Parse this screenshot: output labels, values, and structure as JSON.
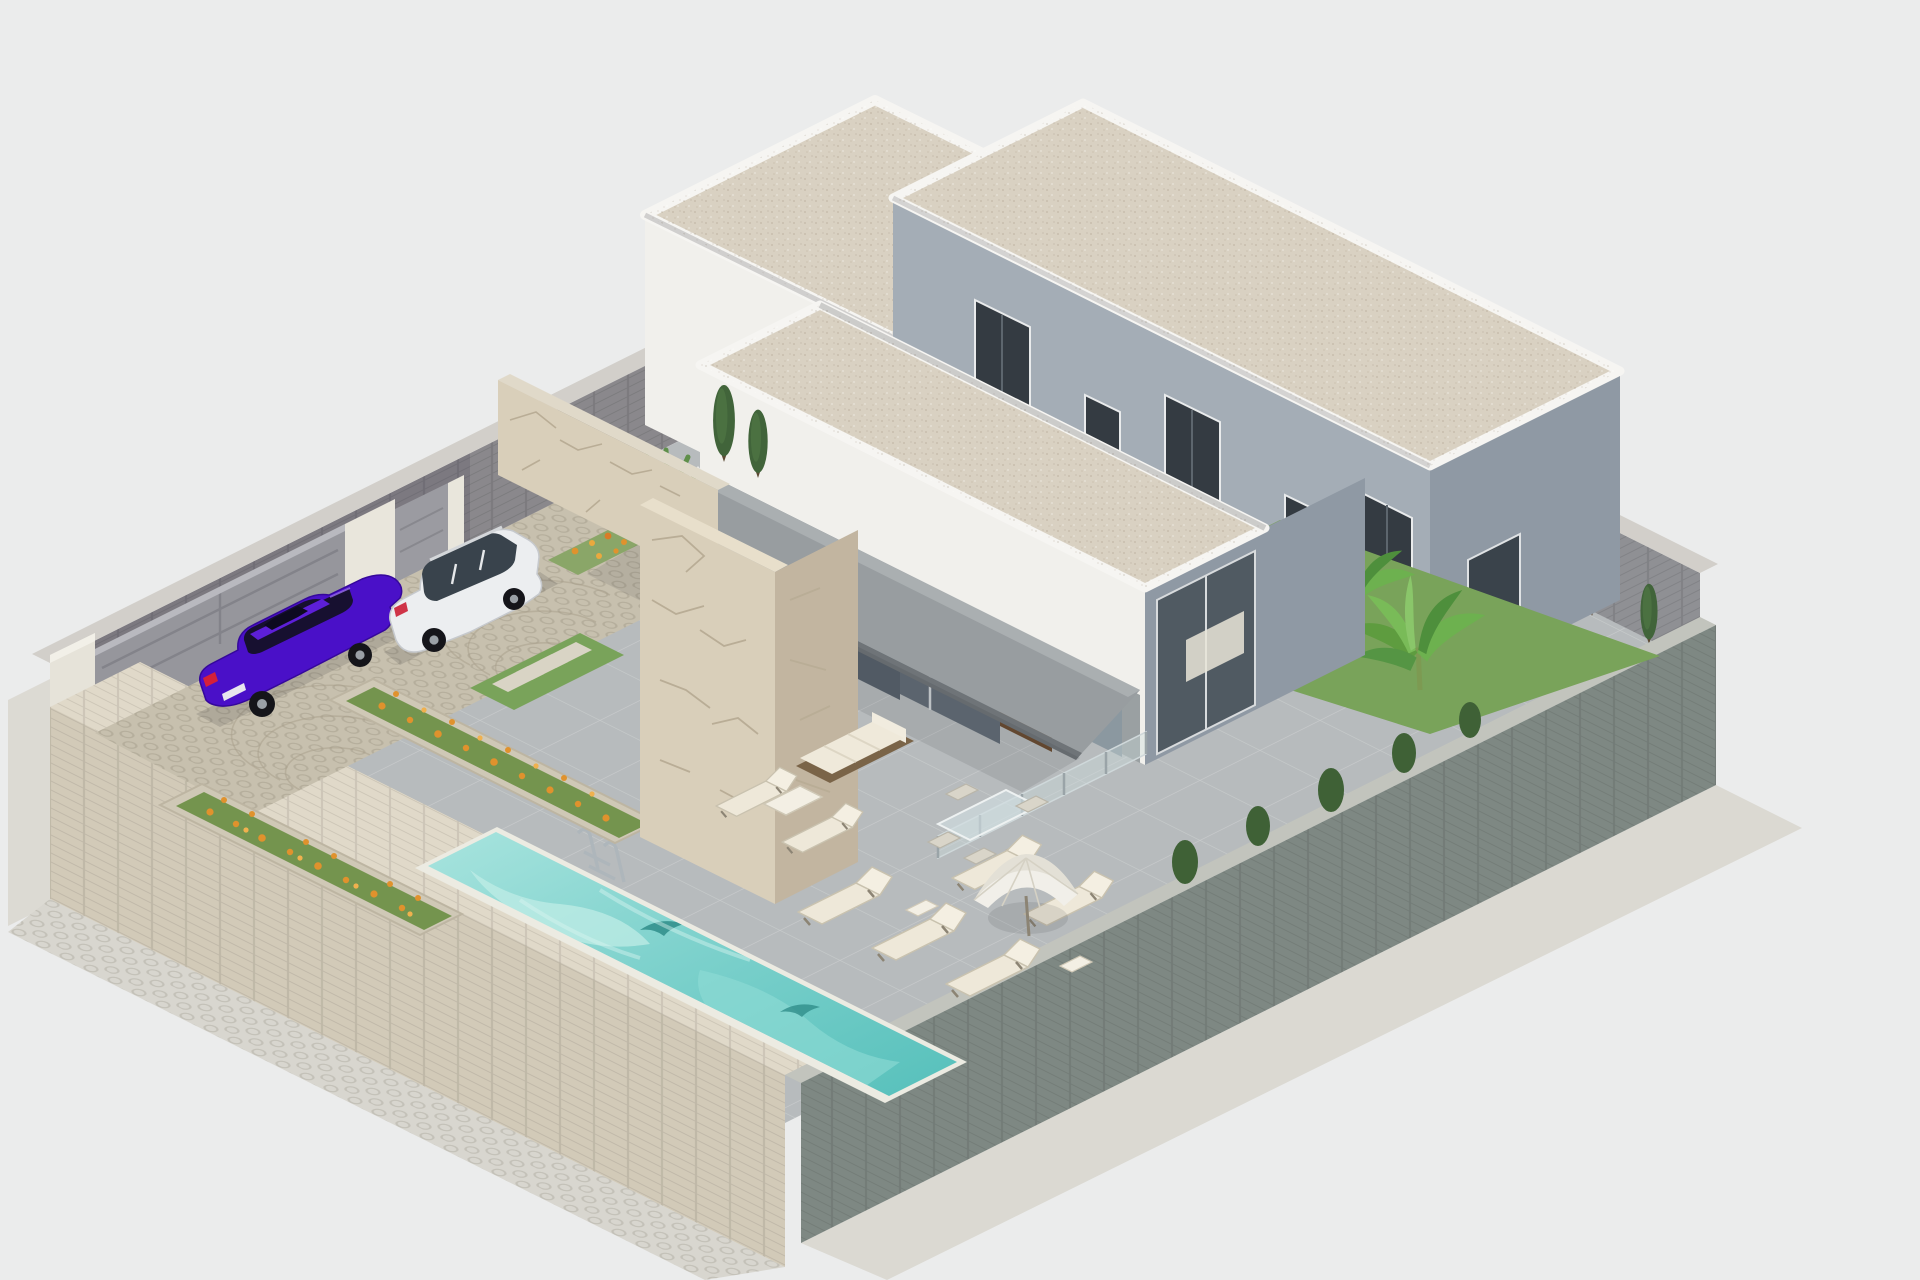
{
  "scene": {
    "kind": "isometric-architectural-render",
    "subject": "modern single-storey villa plot with swimming pool, parking court and gardens"
  },
  "colors": {
    "background": "#ebecec",
    "apron": "#dcdad3",
    "deck": "#b7bbbd",
    "cobble": "#c7c0ae",
    "wall_brick": "#8a888c",
    "wall_brick_light": "#d2cfca",
    "wall_sage": "#7e8883",
    "wall_stone": "#d2cab8",
    "wall_stone_top": "#e0d9c9",
    "gate_gray": "#96969c",
    "pillar_white": "#e9e6dc",
    "building_white": "#f1f0ec",
    "building_white_shade": "#dfdeda",
    "building_gray": "#a4adb6",
    "building_gray_shade": "#8f99a4",
    "roof_gravel": "#d9d1c2",
    "roof_parapet": "#f6f5f2",
    "stone_clad": "#d9cfba",
    "stone_clad_shade": "#c2b5a0",
    "awning": "#989da0",
    "awning_edge": "#6f7478",
    "glass": "#4f5a63",
    "glass_light": "#8b98a0",
    "door_wood": "#6a4c31",
    "coping": "#ecebe2",
    "water_light": "#a5e3dd",
    "water_deep": "#5cc6c1",
    "dolphin": "#2f8d8a",
    "grass": "#79a35a",
    "leaf": "#6db14f",
    "cypress": "#41643a",
    "flower": "#e0922d",
    "furniture_white": "#efe9da",
    "furniture_wood": "#7a6448",
    "umbrella": "#f1efe9",
    "shadow": "rgba(30,30,35,0.14)"
  },
  "plot": {
    "walls": {
      "front": "beige stone",
      "rear": "grey brick",
      "side": "sage-grey brick",
      "gates": 2
    },
    "buildings": [
      {
        "name": "rear-left-villa",
        "storeys": 1,
        "roof": "flat gravel"
      },
      {
        "name": "rear-right-villa",
        "storeys": 1,
        "roof": "flat gravel",
        "windows": 5
      },
      {
        "name": "main-house",
        "storeys": 1,
        "roof": "flat gravel",
        "features": [
          "grey awning",
          "stone-clad pillar",
          "sliding glass doors",
          "timber door"
        ]
      }
    ],
    "pool": {
      "water_color": "#5cc6c1",
      "features": [
        "chrome ladder",
        "dolphin mosaic"
      ]
    },
    "vehicles": [
      {
        "type": "sedan",
        "color_name": "purple",
        "color": "#4a10c8"
      },
      {
        "type": "suv",
        "color_name": "white",
        "color": "#eceef0"
      }
    ],
    "vegetation": {
      "cypress_trees": 14,
      "banana_plants": 4,
      "flower_planters": 3,
      "flower_color": "#e0922d"
    },
    "furniture": {
      "sun_loungers": 7,
      "outdoor_sofa": 1,
      "dining_chairs": 5,
      "parasol": 1,
      "glass_balustrade": 1
    }
  }
}
